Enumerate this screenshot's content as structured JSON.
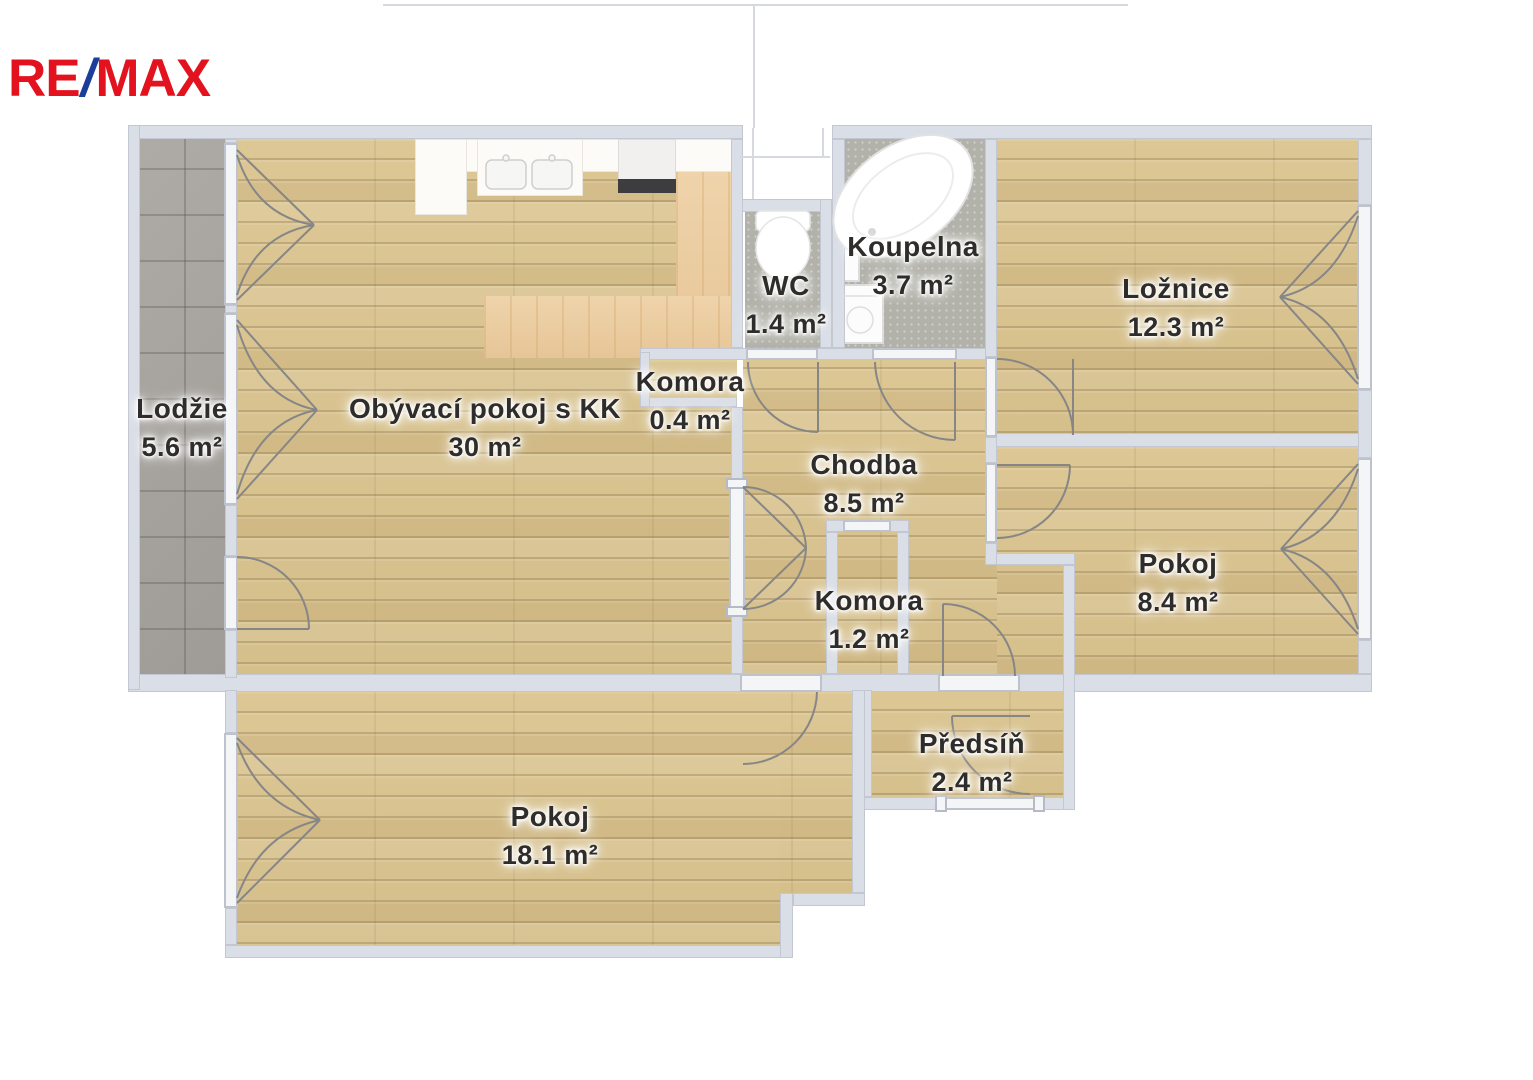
{
  "logo": {
    "re": "RE",
    "slash": "/",
    "max": "MAX"
  },
  "brand_colors": {
    "remax_red": "#e2131f",
    "remax_blue": "#1b3e9b"
  },
  "palette": {
    "wall": "#dadee6",
    "wood_floor": "#d9c491",
    "balcony_tile": "#a9a6a1",
    "bath_tile": "#b2b2aa"
  },
  "rooms": {
    "lodzie": {
      "name": "Lodžie",
      "area": "5.6 m²"
    },
    "obyvaci": {
      "name": "Obývací pokoj s KK",
      "area": "30 m²"
    },
    "komora_mala": {
      "name": "Komora",
      "area": "0.4 m²"
    },
    "wc": {
      "name": "WC",
      "area": "1.4 m²"
    },
    "koupelna": {
      "name": "Koupelna",
      "area": "3.7 m²"
    },
    "loznice": {
      "name": "Ložnice",
      "area": "12.3 m²"
    },
    "chodba": {
      "name": "Chodba",
      "area": "8.5 m²"
    },
    "komora": {
      "name": "Komora",
      "area": "1.2 m²"
    },
    "pokoj_maly": {
      "name": "Pokoj",
      "area": "8.4 m²"
    },
    "predsin": {
      "name": "Předsíň",
      "area": "2.4 m²"
    },
    "pokoj_velky": {
      "name": "Pokoj",
      "area": "18.1 m²"
    }
  }
}
